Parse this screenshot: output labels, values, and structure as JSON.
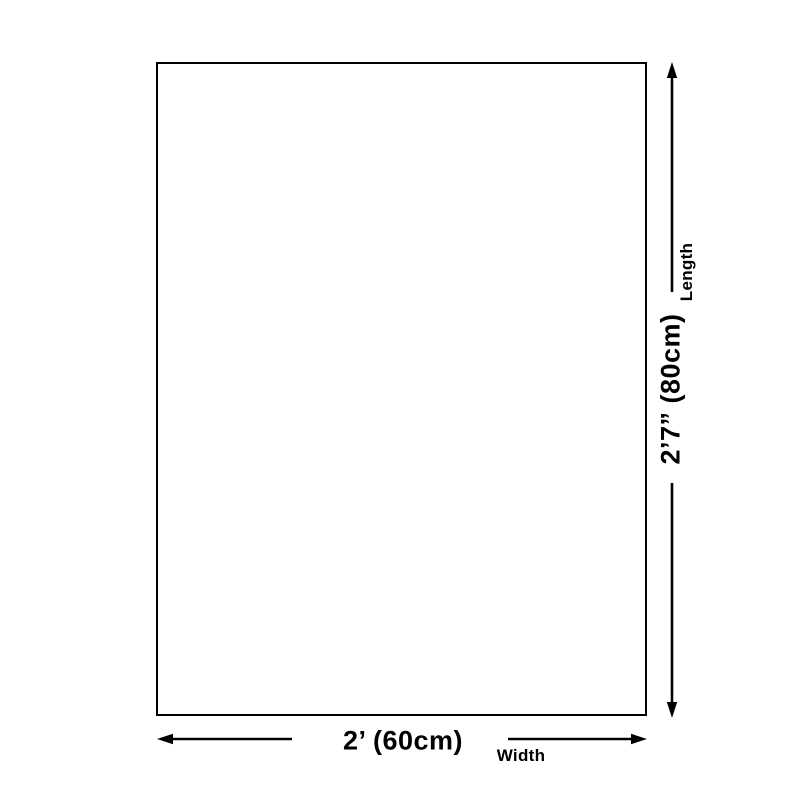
{
  "colors": {
    "background": "#ffffff",
    "ink": "#000000"
  },
  "diagram": {
    "type": "product-size-diagram",
    "product_outline": {
      "fill": "#ffffff",
      "border_color": "#000000"
    },
    "width_dimension": {
      "value": "2’ (60cm)",
      "axis_label": "Width"
    },
    "length_dimension": {
      "value": "2’7” (80cm)",
      "axis_label": "Length"
    }
  }
}
